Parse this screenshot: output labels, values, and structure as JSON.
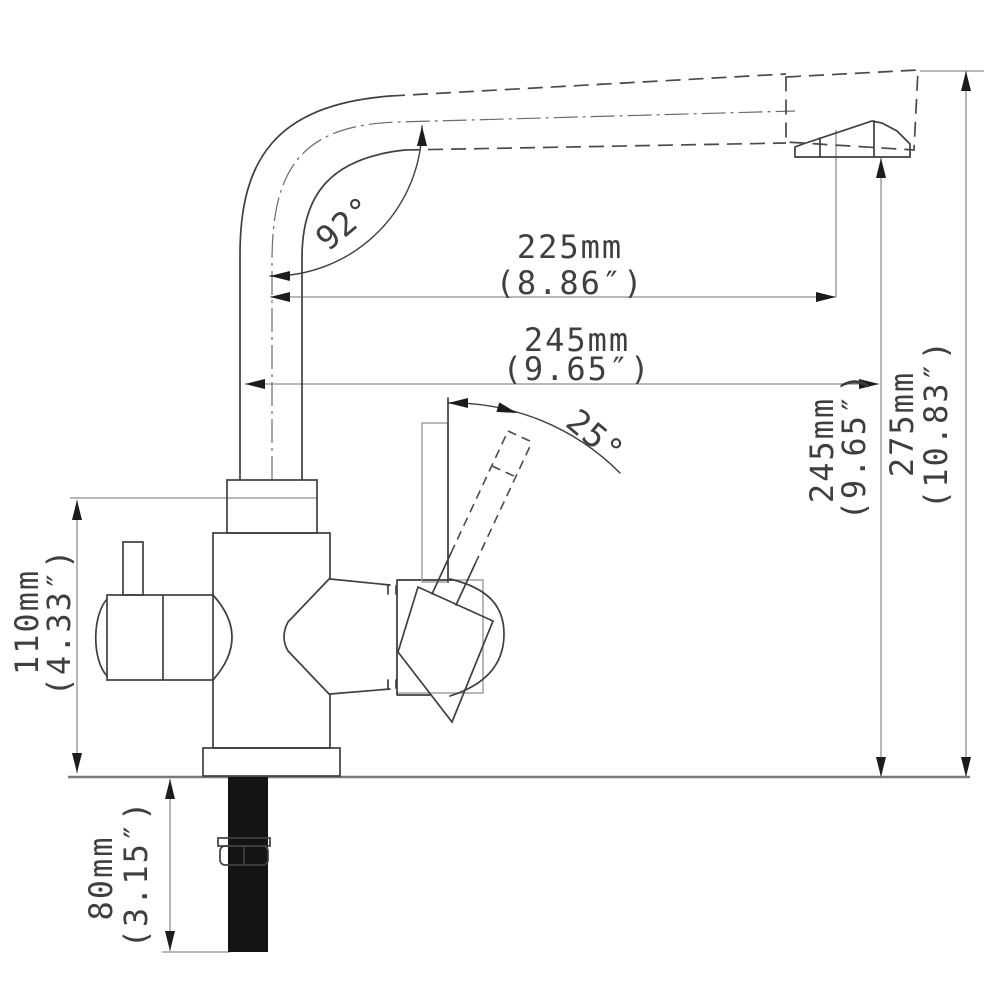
{
  "drawing": {
    "subject": "kitchen-faucet-side-elevation-technical-drawing",
    "dims": {
      "spout_reach": {
        "mm": "225mm",
        "inch": "(8.86″)"
      },
      "spout_total": {
        "mm": "245mm",
        "inch": "(9.65″)"
      },
      "outlet_height": {
        "mm": "245mm",
        "inch": "(9.65″)"
      },
      "overall_height": {
        "mm": "275mm",
        "inch": "(10.83″)"
      },
      "body_height": {
        "mm": "110mm",
        "inch": "(4.33″)"
      },
      "shank_length": {
        "mm": "80mm",
        "inch": "(3.15″)"
      }
    },
    "angles": {
      "spout_bend": "92°",
      "lever_tilt": "25°"
    },
    "colors": {
      "outline": "#3f3f3f",
      "dimension_line": "#8f8f8f",
      "phantom_line": "#9a9a9a",
      "deck_line": "#7a7a7a",
      "text": "#3f3f3f",
      "shank_fill": "#141414",
      "background": "#ffffff"
    }
  }
}
